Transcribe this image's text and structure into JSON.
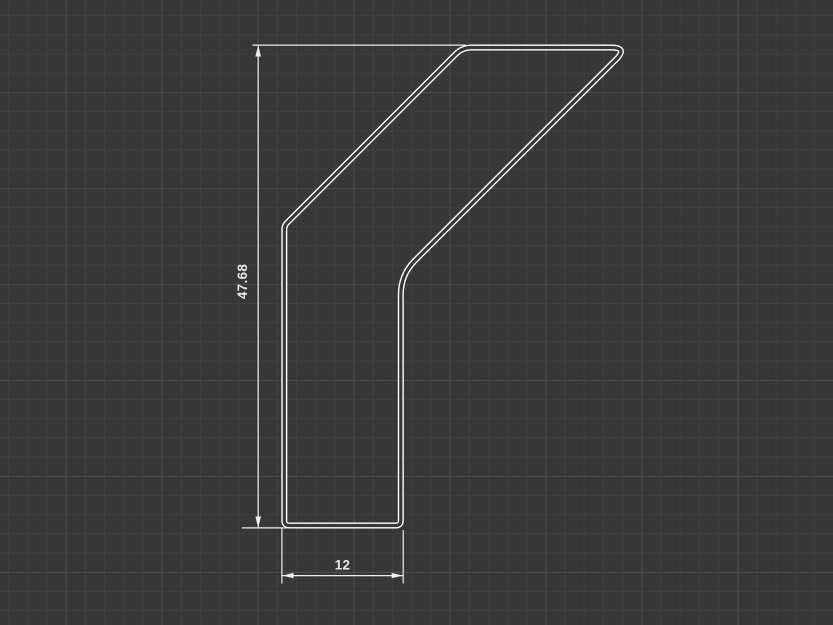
{
  "app": {
    "view_name": "cad-sketch-viewport"
  },
  "canvas": {
    "background_color": "#373737",
    "grid_minor_color": "#3f3f3f",
    "grid_major_color": "#4c4c4c",
    "grid_minor_spacing_px": 19.2,
    "grid_major_spacing_px": 96,
    "profile_line_color": "#ffffff",
    "dimension_color": "#ededed"
  },
  "sketch": {
    "profile": {
      "description": "closed thin-wall bracket profile: vertical lower leg with diagonal arm rising to a flat top cap",
      "units_per_px": 0.0994
    },
    "dimensions": [
      {
        "id": "height",
        "value": "47.68",
        "orientation": "vertical"
      },
      {
        "id": "width",
        "value": "12",
        "orientation": "horizontal"
      }
    ]
  }
}
